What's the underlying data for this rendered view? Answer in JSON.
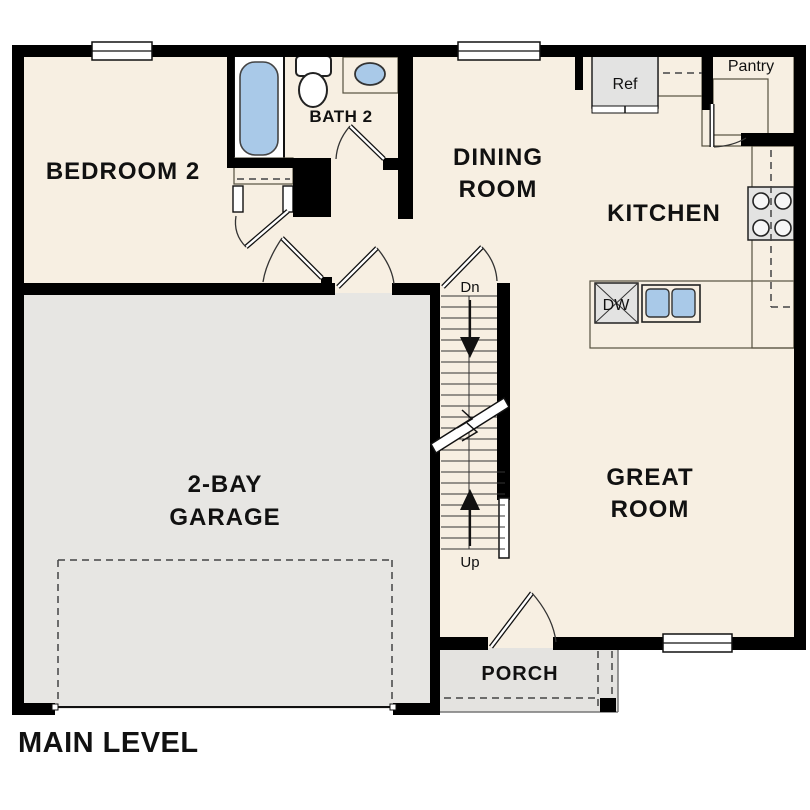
{
  "page": {
    "type": "floor-plan",
    "level_title": "MAIN LEVEL"
  },
  "colors": {
    "wall": "#000000",
    "floor": "#f7efe2",
    "garage": "#e7e6e3",
    "porch": "#e4e3e0",
    "counter": "#d3c5a8",
    "fixture_blue": "#a9c9e8",
    "appliance": "#e3e3e2",
    "text": "#111111",
    "outside": "#ffffff"
  },
  "rooms": [
    {
      "id": "bedroom-2",
      "lines": [
        "BEDROOM 2"
      ]
    },
    {
      "id": "bath-2",
      "lines": [
        "BATH 2"
      ]
    },
    {
      "id": "dining-room",
      "lines": [
        "DINING",
        "ROOM"
      ]
    },
    {
      "id": "kitchen",
      "lines": [
        "KITCHEN"
      ]
    },
    {
      "id": "great-room",
      "lines": [
        "GREAT",
        "ROOM"
      ]
    },
    {
      "id": "garage",
      "lines": [
        "2-BAY",
        "GARAGE"
      ]
    },
    {
      "id": "porch",
      "lines": [
        "PORCH"
      ]
    }
  ],
  "labels": {
    "ref": "Ref",
    "pantry": "Pantry",
    "dishwasher": "DW",
    "stairs_down": "Dn",
    "stairs_up": "Up"
  }
}
